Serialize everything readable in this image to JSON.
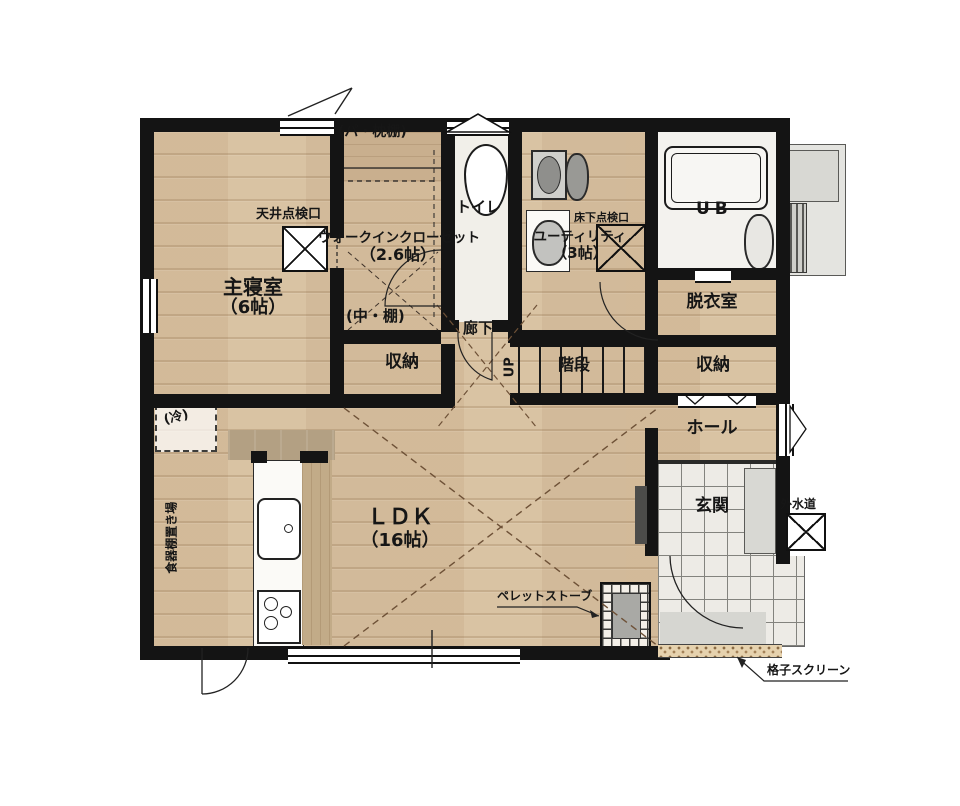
{
  "plan": {
    "rooms": {
      "master_bedroom": {
        "name": "主寝室",
        "size": "（6帖）"
      },
      "walk_in_closet": {
        "name": "ウォークインクローゼット",
        "size": "（2.6帖）"
      },
      "toilet": {
        "name": "トイレ"
      },
      "utility": {
        "name": "ユーティリティ",
        "size": "（3帖）"
      },
      "unit_bath": {
        "name": "UB"
      },
      "dressing_room": {
        "name": "脱衣室"
      },
      "storage_upper": {
        "name": "収納"
      },
      "storage_lower": {
        "name": "収納"
      },
      "hall": {
        "name": "ホール"
      },
      "entrance": {
        "name": "玄関"
      },
      "corridor": {
        "name": "廊下"
      },
      "stairs": {
        "name": "階段"
      },
      "ldk": {
        "name": "ＬＤＫ",
        "size": "（16帖）"
      }
    },
    "annotations": {
      "ceiling_access": "天井点検口",
      "underfloor_access": "床下点検口",
      "pipe_pillow_shelf": "(パ・枕棚)",
      "middle_shelf": "(中・棚)",
      "up": "UP",
      "refrigerator": "(冷)",
      "cupboard_space": "食器棚置き場",
      "pellet_stove": "ペレットストーブ",
      "outdoor_faucet": "外水道",
      "lattice_screen": "格子スクリーン"
    },
    "colors": {
      "wall": "#141414",
      "wood_floor": "#d9c3a3",
      "tile_floor": "#edebe6",
      "counter": "#b3a083"
    }
  }
}
